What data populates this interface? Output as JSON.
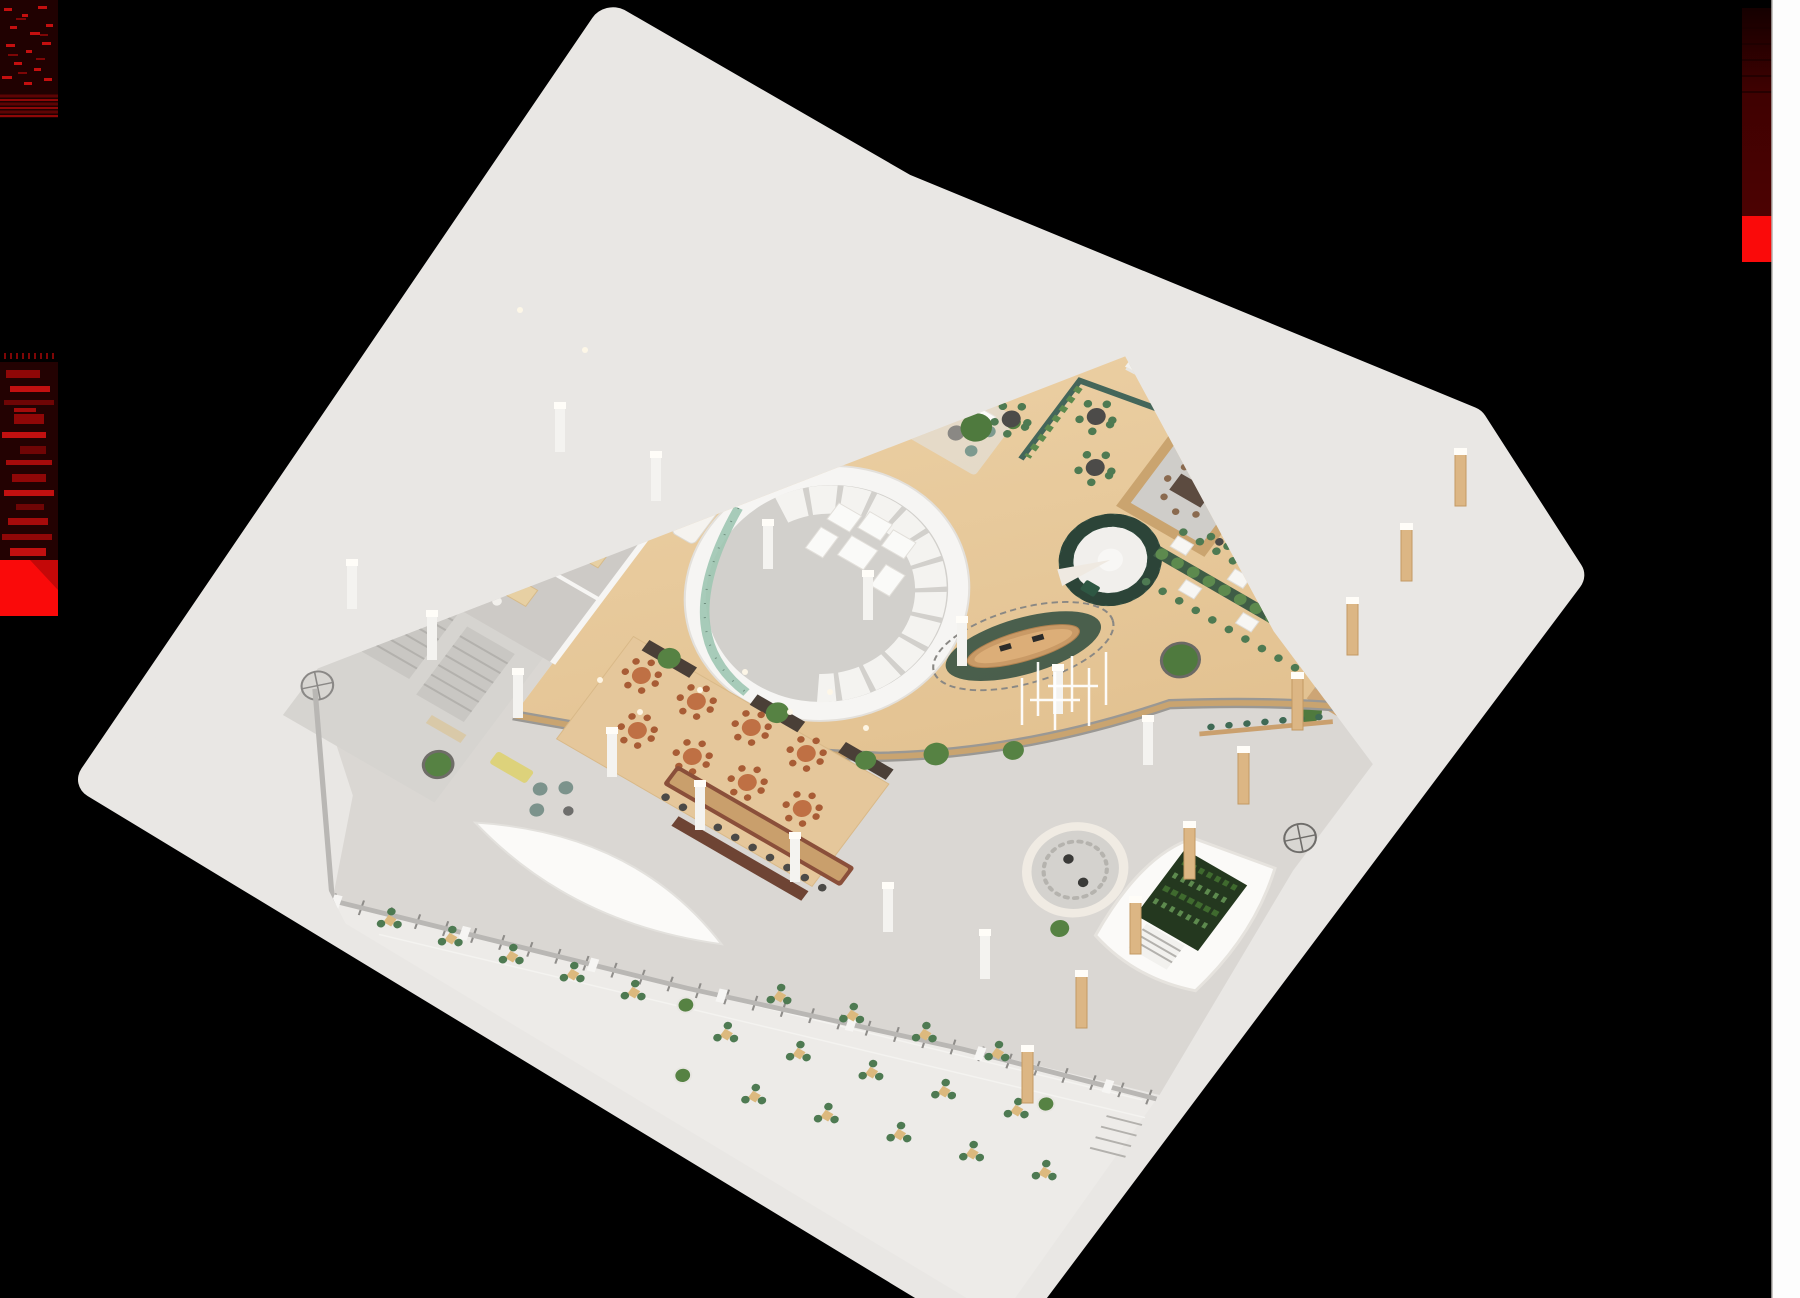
{
  "scene": {
    "title": "Isometric 3D architectural rendering of a large office and library floor plate on a black background",
    "view": "axonometric cutaway, single floor"
  },
  "colors": {
    "background": "#000000",
    "pavement": "#e9e7e4",
    "patio": "#edebe8",
    "terrace": "#dad7d3",
    "concrete": "#d6d4d0",
    "carpet": "#cdcac6",
    "wood_light": "#eed3a8",
    "wood_dark": "#dcb884",
    "wall_white": "#f6f5f3",
    "wall_shadow": "#e3e0da",
    "mullion": "#dbd8d3",
    "green_wall": "#44665a",
    "green_glass": "#9fc6b2",
    "spiral_green": "#3c5a4c",
    "plant": "#568243",
    "plant_dark": "#3f5d46",
    "terracotta": "#bf7044",
    "chair_green": "#4e7a52",
    "chair_white": "#f2f0ec",
    "wood_furniture": "#dcc092",
    "bar_brown": "#8a4f3a",
    "bar_top": "#c99f6c",
    "teal_rug": "#8fc0b4",
    "desk_wood": "#c99a66",
    "rug_green": "#2f4c40",
    "pillar_wood": "#dcb684",
    "glass_frame": "#55534f",
    "red_bright": "#fa0a0a",
    "red_dark": "#3f0101",
    "red_mid": "#8f0707",
    "strip_white": "#fdfdfd"
  },
  "artifacts": {
    "top_left_glitch": {
      "description": "dark red scanline noise block",
      "color": "#200101"
    },
    "left_red_thumbnail": {
      "description": "red-tinted corrupted thumbnail of interior render",
      "color": "#230202"
    },
    "left_red_square": {
      "description": "bright red block",
      "color": "#fa0a0a"
    },
    "right_red_column": {
      "description": "dark red gradient column with bright red block",
      "color": "#3f0101"
    },
    "right_white_strip": {
      "description": "white vertical strip at right edge",
      "color": "#fdfdfd"
    }
  },
  "floorplan": {
    "zones": [
      {
        "id": "conference-room",
        "name": "conference room with hollow ring table and chairs"
      },
      {
        "id": "library-reading-room",
        "name": "reading room with long study tables"
      },
      {
        "id": "book-stacks",
        "name": "double-sided wooden bookshelf stacks"
      },
      {
        "id": "washroom-block",
        "name": "small enclosed rooms at left corner"
      },
      {
        "id": "stair-concrete-zone",
        "name": "concrete lobby with stairs and revolving door"
      },
      {
        "id": "circular-core",
        "name": "round white core with phone rooms and green glass wall"
      },
      {
        "id": "tree-round-table",
        "name": "round communal table with tree centerpiece"
      },
      {
        "id": "coffee-counter",
        "name": "long white coffee counter"
      },
      {
        "id": "lounge-sofas",
        "name": "white sofa lounge"
      },
      {
        "id": "long-meeting-table",
        "name": "long white meeting table"
      },
      {
        "id": "courtyard-cafe",
        "name": "green-partitioned courtyard cafe"
      },
      {
        "id": "focus-rooms",
        "name": "focus rooms with X-shaped desks"
      },
      {
        "id": "sunken-meeting-pit",
        "name": "sunken wood-framed meeting pit"
      },
      {
        "id": "spiral-staircase",
        "name": "dark green spiral staircase"
      },
      {
        "id": "reception-desk",
        "name": "oval reception desk with queue rail"
      },
      {
        "id": "cafeteria-rows",
        "name": "planted cafeteria table rows"
      },
      {
        "id": "tiered-seating",
        "name": "wooden bleacher seating steps"
      },
      {
        "id": "reading-lounge",
        "name": "teal rug lounge"
      },
      {
        "id": "mezzanine-edge",
        "name": "curved wood-capped balcony edge"
      },
      {
        "id": "terrace-cafe",
        "name": "terracotta terrace cafe deck"
      },
      {
        "id": "terrace-bar",
        "name": "long terrace bar with stools"
      },
      {
        "id": "sunken-circle",
        "name": "circular sunken seat with light-stick chandelier"
      },
      {
        "id": "green-wall-pod",
        "name": "white pod with vertical garden and stair"
      },
      {
        "id": "outdoor-patio",
        "name": "outdoor patio with bistro sets"
      },
      {
        "id": "glass-facade",
        "name": "mullioned glass curtain wall"
      },
      {
        "id": "colonnade",
        "name": "timber column walkway"
      }
    ]
  }
}
